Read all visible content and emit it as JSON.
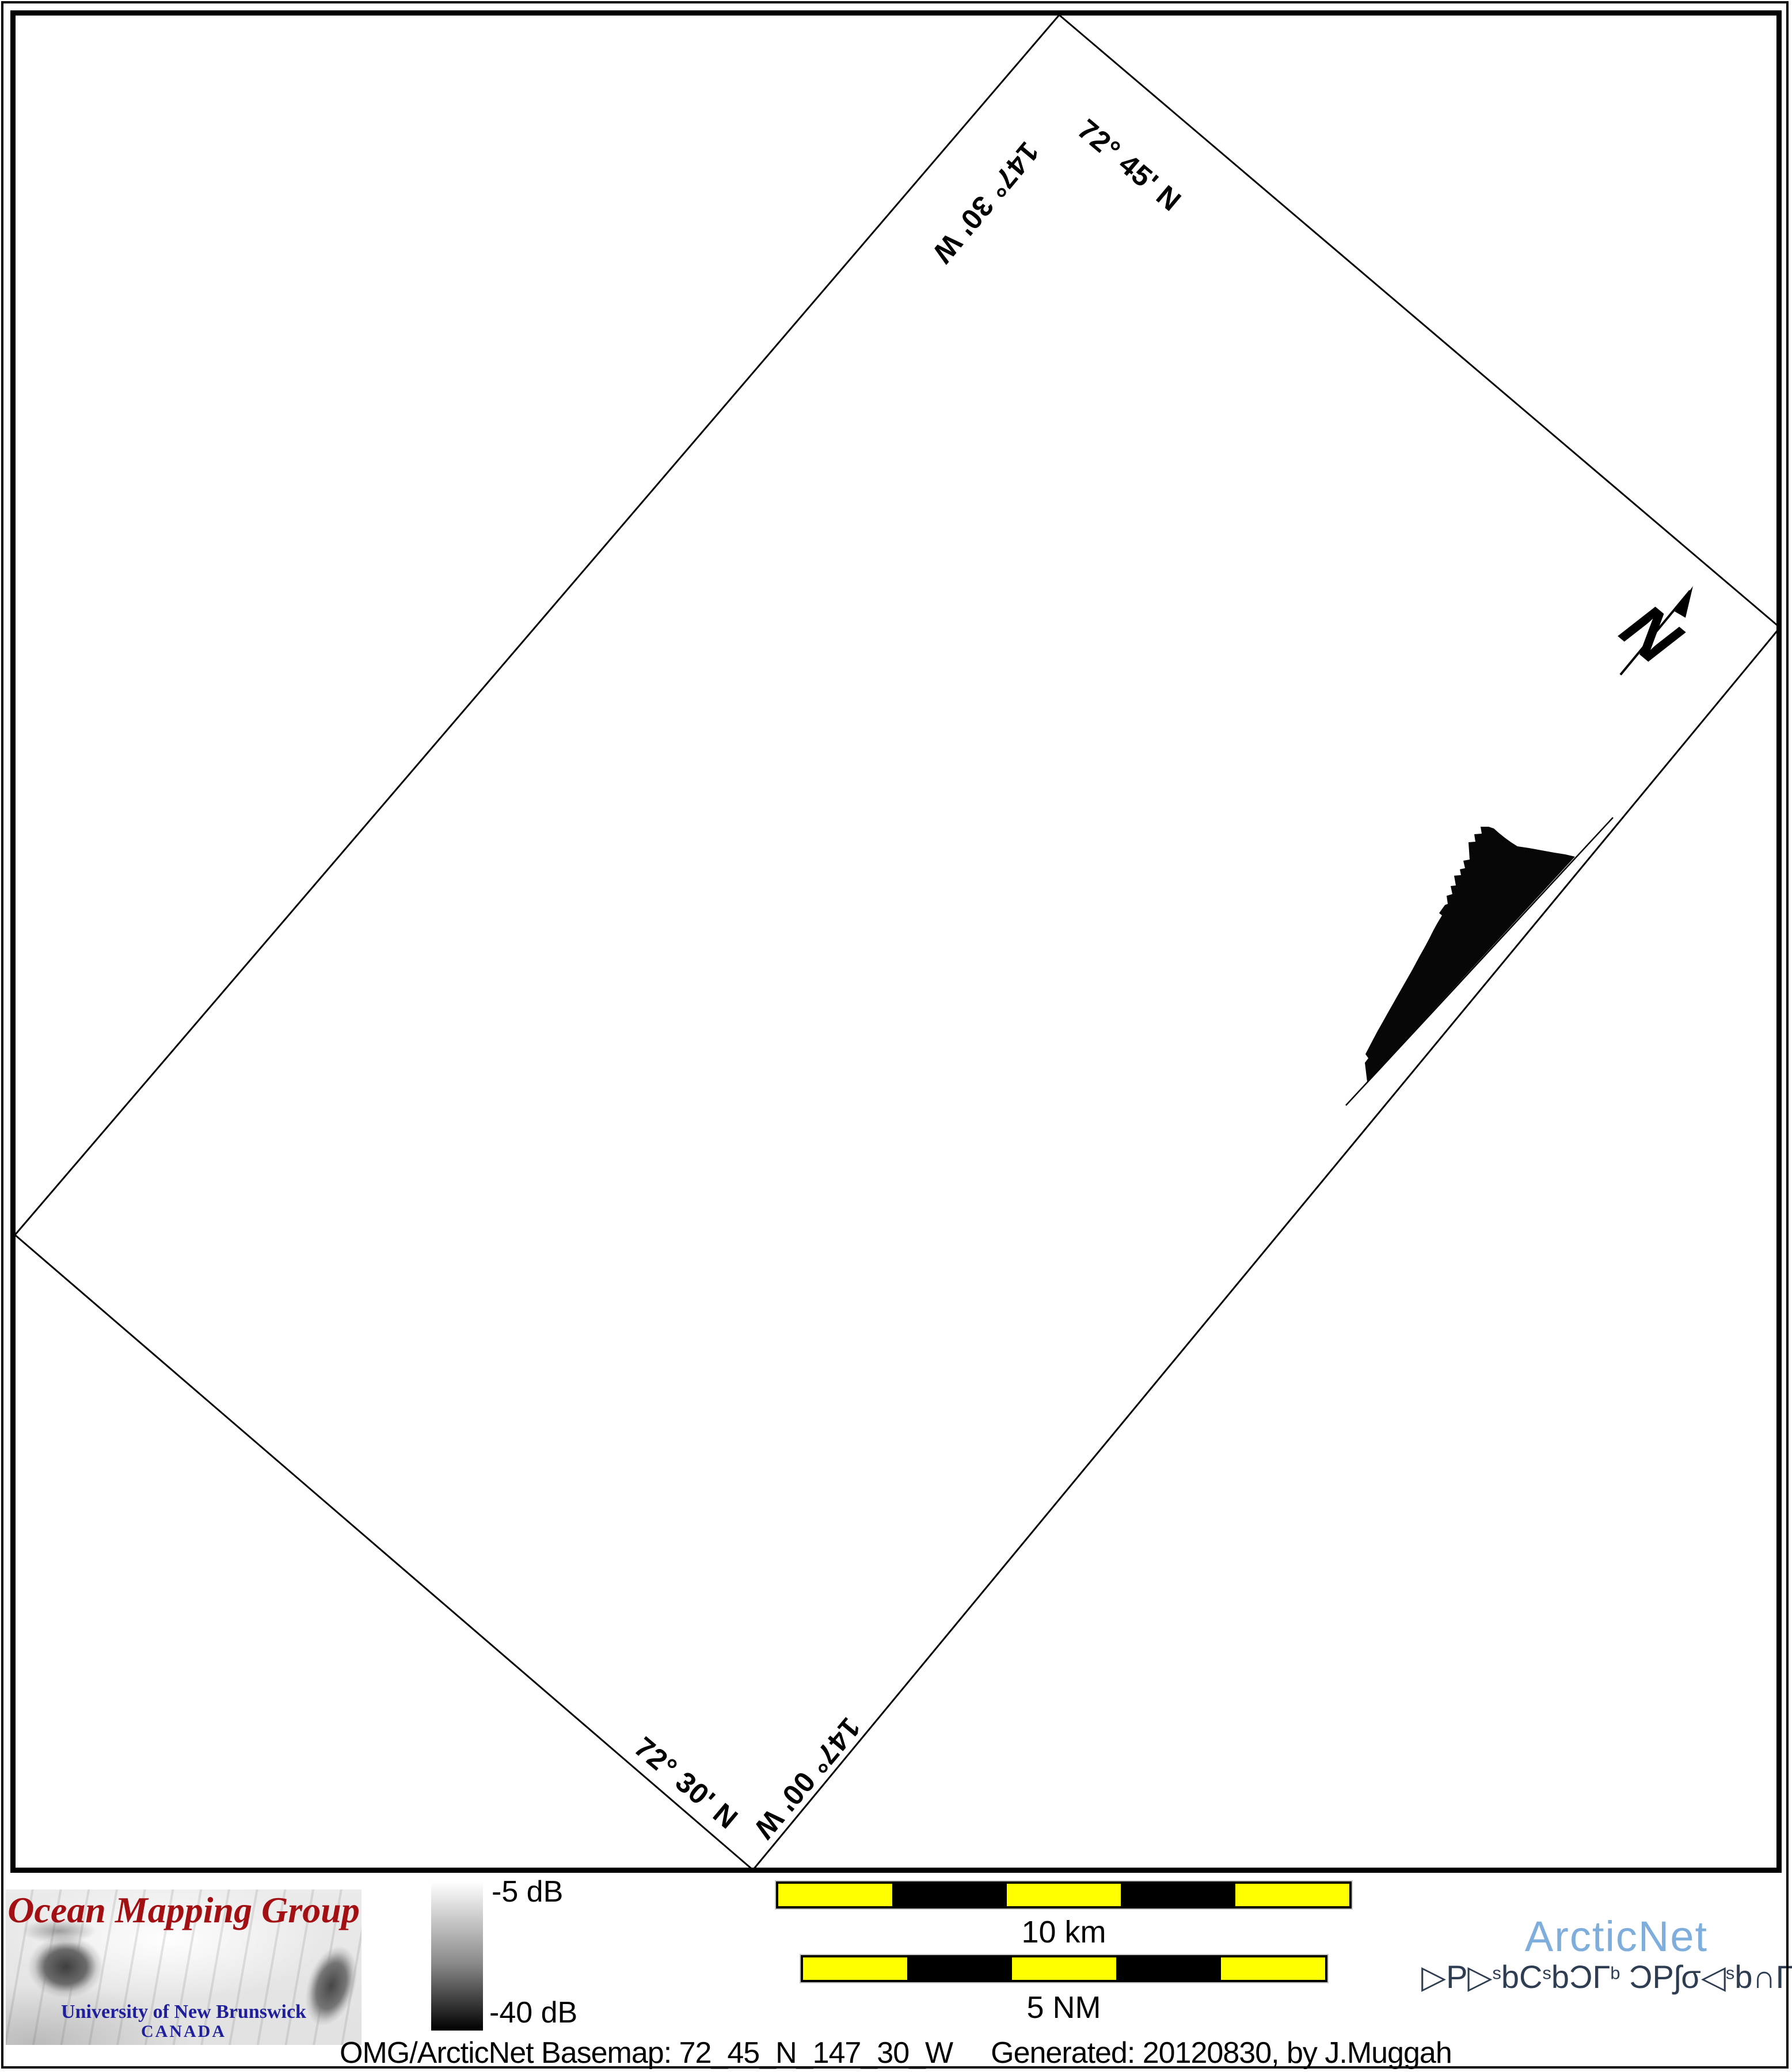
{
  "map": {
    "corner_labels": {
      "lat_top": "72° 45' N",
      "lon_top": "147° 30' W",
      "lat_bottom": "72° 30' N",
      "lon_bottom": "147° 00' W"
    },
    "north_label": "N"
  },
  "legend": {
    "top_label": "-5 dB",
    "bottom_label": "-40 dB"
  },
  "scalebars": {
    "km": {
      "label": "10 km",
      "segments": 5
    },
    "nm": {
      "label": "5 NM",
      "segments": 5
    }
  },
  "omg_logo": {
    "title": "Ocean Mapping Group",
    "subtitle": "University of New Brunswick",
    "country": "CANADA"
  },
  "arcticnet": {
    "wordmark": "ArcticNet",
    "inuktitut_segments": [
      {
        "t": "▷P▷"
      },
      {
        "t": "s",
        "sup": true
      },
      {
        "t": "bC"
      },
      {
        "t": "s",
        "sup": true
      },
      {
        "t": "bƆΓ"
      },
      {
        "t": "b",
        "sup": true
      },
      {
        "t": "  ƆPʃσ◁"
      },
      {
        "t": "s",
        "sup": true
      },
      {
        "t": "b∩Γ̇"
      },
      {
        "t": "c",
        "sup": true
      }
    ]
  },
  "caption": {
    "left": "OMG/ArcticNet Basemap: 72_45_N_147_30_W",
    "right": "Generated: 20120830, by J.Muggah"
  },
  "colors": {
    "scalebar_yellow": "#ffff00",
    "swath_black": "#070707",
    "omg_red": "#a31014",
    "unb_blue": "#1f1f9c",
    "arcticnet_blue": "#7faedc",
    "inuktitut_navy": "#2e3d52"
  }
}
